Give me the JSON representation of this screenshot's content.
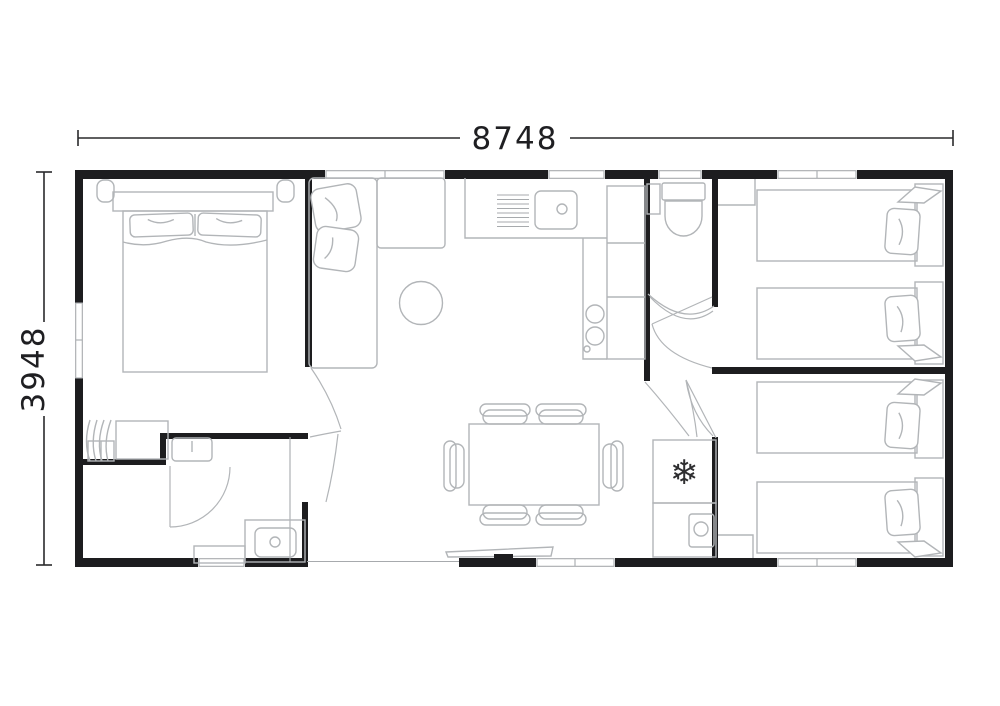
{
  "floor_plan": {
    "width_dimension": "8748",
    "height_dimension": "3948",
    "fridge_icon": "❄",
    "colors": {
      "wall": "#1d1d1f",
      "furniture_line": "#b2b5b8",
      "dimension": "#2a2a2c",
      "background": "#ffffff"
    }
  }
}
